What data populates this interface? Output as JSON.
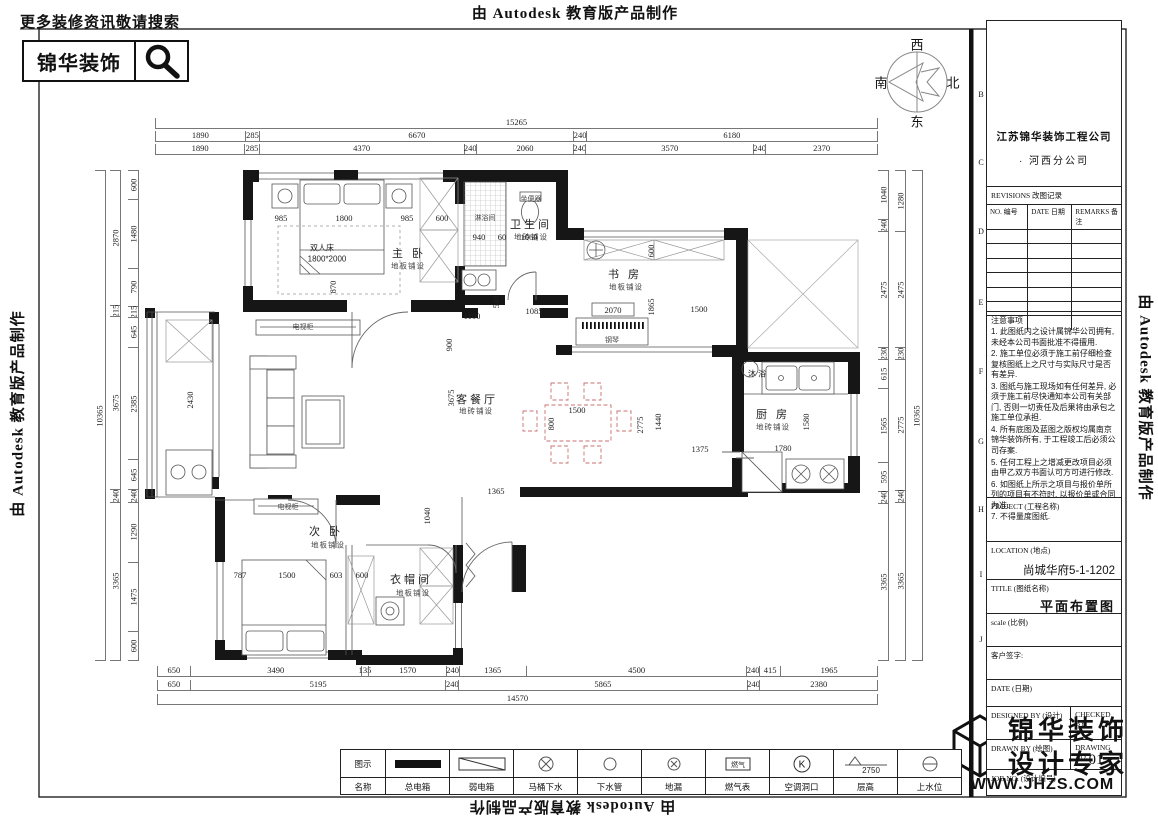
{
  "watermark": {
    "text": "由 Autodesk 教育版产品制作"
  },
  "header": {
    "search_hint": "更多装修资讯敬请搜索",
    "brand": "锦华装饰"
  },
  "compass": {
    "west": "西",
    "north": "北",
    "south": "南",
    "east": "东"
  },
  "colors": {
    "wall": "#161616",
    "dining_set": "#c87070",
    "dim_line": "#777777"
  },
  "grid_letters": [
    {
      "t": "B",
      "y": 95
    },
    {
      "t": "C",
      "y": 163
    },
    {
      "t": "D",
      "y": 232
    },
    {
      "t": "E",
      "y": 303
    },
    {
      "t": "F",
      "y": 372
    },
    {
      "t": "G",
      "y": 442
    },
    {
      "t": "H",
      "y": 510
    },
    {
      "t": "I",
      "y": 575
    },
    {
      "t": "J",
      "y": 640
    }
  ],
  "title_block": {
    "company_line1": "江苏锦华装饰工程公司",
    "company_line2": "· 河西分公司",
    "revisions": {
      "title": "REVISIONS 改图记录",
      "col_no": "NO. 编号",
      "col_date": "DATE 日期",
      "col_remarks": "REMARKS 备注",
      "empty_rows": 7
    },
    "notes_title": "注意事项",
    "notes": [
      "1. 此图纸内之设计属锦华公司拥有, 未经本公司书面批准不得擅用.",
      "2. 施工单位必须于施工前仔细检查复核图纸上之尺寸与实际尺寸是否有差异.",
      "3. 图纸与施工现场如有任何差异, 必须于施工前尽快通知本公司有关部门, 否则一切责任及后果将由承包之施工单位承担.",
      "4. 所有底图及蓝图之版权均属南京锦华装饰所有, 于工程竣工后必须公司存案.",
      "5. 任何工程上之增减更改项目必须由甲乙双方书面认可方可进行修改.",
      "6. 如图纸上所示之项目与报价单所列的项目有不符时, 以报价单或合同为准.",
      "7. 不得量度图纸."
    ],
    "project_label": "PROJECT (工程名称)",
    "location_label": "LOCATION (地点)",
    "location_value": "尚城华府5-1-1202",
    "drawing_title_label": "TITLE (图纸名称)",
    "drawing_title_value": "平面布置图",
    "scale_label": "scale (比例)",
    "client_sign_label": "客户签字:",
    "date_label": "DATE (日期)",
    "designed_by_label": "DESIGNED BY (设计)",
    "checked_by_label": "CHECKED BY",
    "drawn_by_label": "DRAWN BY (绘图)",
    "drawing_no_label": "DRAWING NO.",
    "job_no_label": "JOB NO. (设计编号)",
    "drawing_no_value": "01"
  },
  "footer_logo": {
    "line1": "锦华装饰",
    "line2": "设计专家",
    "url": "WWW.JHZS.COM"
  },
  "legend": {
    "row1_label": "图示",
    "row2_label": "名称",
    "items": [
      {
        "name": "总电箱",
        "symbol": "filled-bar"
      },
      {
        "name": "弱电箱",
        "symbol": "diagonal-box"
      },
      {
        "name": "马桶下水",
        "symbol": "circle-x"
      },
      {
        "name": "下水管",
        "symbol": "circle"
      },
      {
        "name": "地漏",
        "symbol": "circle-small-x"
      },
      {
        "name": "燃气表",
        "symbol": "gas-box",
        "symbol_text": "燃气"
      },
      {
        "name": "空调洞口",
        "symbol": "circle-k",
        "symbol_text": "K"
      },
      {
        "name": "层高",
        "symbol": "level-triangle",
        "symbol_text": "2750"
      },
      {
        "name": "上水位",
        "symbol": "circle-dash"
      }
    ]
  },
  "dims": {
    "top": [
      [
        15265
      ],
      [
        1890,
        285,
        6670,
        240,
        6180
      ],
      [
        1890,
        285,
        4370,
        240,
        2060,
        240,
        3570,
        240,
        2370
      ]
    ],
    "bottom": [
      [
        650,
        3490,
        135,
        1570,
        240,
        1365,
        4500,
        240,
        415,
        1965
      ],
      [
        650,
        5195,
        240,
        5865,
        240,
        2380
      ],
      [
        14570
      ]
    ],
    "left_outer": [
      10365
    ],
    "left_mid": [
      2870,
      215,
      3675,
      240,
      3365
    ],
    "left_inner": [
      600,
      1480,
      790,
      215,
      645,
      2385,
      645,
      240,
      1290,
      1475,
      600
    ],
    "right_inner": [
      1040,
      240,
      2475,
      230,
      615,
      1565,
      595,
      240,
      3365
    ],
    "right_mid": [
      1280,
      2475,
      230,
      2775,
      240,
      3365
    ],
    "right_outer": [
      10365
    ]
  },
  "plan_labels": [
    {
      "t": "主 卧",
      "x": 409,
      "y": 253,
      "c": "room"
    },
    {
      "t": "地板铺设",
      "x": 408,
      "y": 266,
      "c": "sub"
    },
    {
      "t": "卫生间",
      "x": 531,
      "y": 224,
      "c": "room"
    },
    {
      "t": "地砖铺设",
      "x": 531,
      "y": 237,
      "c": "sub"
    },
    {
      "t": "书 房",
      "x": 625,
      "y": 274,
      "c": "room"
    },
    {
      "t": "地板铺设",
      "x": 626,
      "y": 287,
      "c": "sub"
    },
    {
      "t": "客餐厅",
      "x": 477,
      "y": 399,
      "c": "room"
    },
    {
      "t": "地砖铺设",
      "x": 476,
      "y": 411,
      "c": "sub"
    },
    {
      "t": "厨 房",
      "x": 773,
      "y": 414,
      "c": "room"
    },
    {
      "t": "地砖铺设",
      "x": 773,
      "y": 427,
      "c": "sub"
    },
    {
      "t": "次 卧",
      "x": 326,
      "y": 531,
      "c": "room"
    },
    {
      "t": "地板铺设",
      "x": 328,
      "y": 545,
      "c": "sub"
    },
    {
      "t": "衣帽间",
      "x": 411,
      "y": 579,
      "c": "room"
    },
    {
      "t": "地板铺设",
      "x": 413,
      "y": 593,
      "c": "sub"
    },
    {
      "t": "沐 浴",
      "x": 757,
      "y": 374,
      "c": "small"
    },
    {
      "t": "双人床",
      "x": 322,
      "y": 248,
      "c": "small"
    },
    {
      "t": "1800*2000",
      "x": 327,
      "y": 259,
      "c": "small"
    },
    {
      "t": "电视柜",
      "x": 303,
      "y": 327,
      "c": "tiny"
    },
    {
      "t": "电视柜",
      "x": 288,
      "y": 507,
      "c": "tiny"
    },
    {
      "t": "钢琴",
      "x": 612,
      "y": 340,
      "c": "tiny"
    },
    {
      "t": "淋浴间",
      "x": 485,
      "y": 218,
      "c": "tiny"
    },
    {
      "t": "坐便器",
      "x": 531,
      "y": 199,
      "c": "tiny"
    },
    {
      "t": "985",
      "x": 281,
      "y": 218,
      "c": "dim"
    },
    {
      "t": "1800",
      "x": 344,
      "y": 218,
      "c": "dim"
    },
    {
      "t": "985",
      "x": 407,
      "y": 218,
      "c": "dim"
    },
    {
      "t": "600",
      "x": 442,
      "y": 218,
      "c": "dim"
    },
    {
      "t": "940",
      "x": 479,
      "y": 237,
      "c": "dim"
    },
    {
      "t": "60",
      "x": 502,
      "y": 237,
      "c": "dim"
    },
    {
      "t": "1060",
      "x": 529,
      "y": 237,
      "c": "dim"
    },
    {
      "t": "870",
      "x": 333,
      "y": 287,
      "c": "dimv"
    },
    {
      "t": "2430",
      "x": 190,
      "y": 400,
      "c": "dimv"
    },
    {
      "t": "1100",
      "x": 472,
      "y": 316,
      "c": "dim"
    },
    {
      "t": "900",
      "x": 449,
      "y": 345,
      "c": "dimv"
    },
    {
      "t": "540",
      "x": 496,
      "y": 302,
      "c": "dimv"
    },
    {
      "t": "1085",
      "x": 534,
      "y": 311,
      "c": "dim"
    },
    {
      "t": "2070",
      "x": 613,
      "y": 310,
      "c": "dim"
    },
    {
      "t": "600",
      "x": 651,
      "y": 251,
      "c": "dimv"
    },
    {
      "t": "1865",
      "x": 651,
      "y": 307,
      "c": "dimv"
    },
    {
      "t": "1500",
      "x": 699,
      "y": 309,
      "c": "dim"
    },
    {
      "t": "3675",
      "x": 451,
      "y": 398,
      "c": "dimv"
    },
    {
      "t": "1500",
      "x": 577,
      "y": 410,
      "c": "dim"
    },
    {
      "t": "800",
      "x": 551,
      "y": 424,
      "c": "dimv"
    },
    {
      "t": "2775",
      "x": 640,
      "y": 425,
      "c": "dimv"
    },
    {
      "t": "1440",
      "x": 658,
      "y": 422,
      "c": "dimv"
    },
    {
      "t": "1365",
      "x": 496,
      "y": 491,
      "c": "dim"
    },
    {
      "t": "1375",
      "x": 700,
      "y": 449,
      "c": "dim"
    },
    {
      "t": "1780",
      "x": 783,
      "y": 448,
      "c": "dim"
    },
    {
      "t": "1580",
      "x": 806,
      "y": 422,
      "c": "dimv"
    },
    {
      "t": "787",
      "x": 240,
      "y": 575,
      "c": "dim"
    },
    {
      "t": "1500",
      "x": 287,
      "y": 575,
      "c": "dim"
    },
    {
      "t": "603",
      "x": 336,
      "y": 575,
      "c": "dim"
    },
    {
      "t": "600",
      "x": 362,
      "y": 575,
      "c": "dim"
    },
    {
      "t": "1040",
      "x": 427,
      "y": 516,
      "c": "dimv"
    }
  ]
}
